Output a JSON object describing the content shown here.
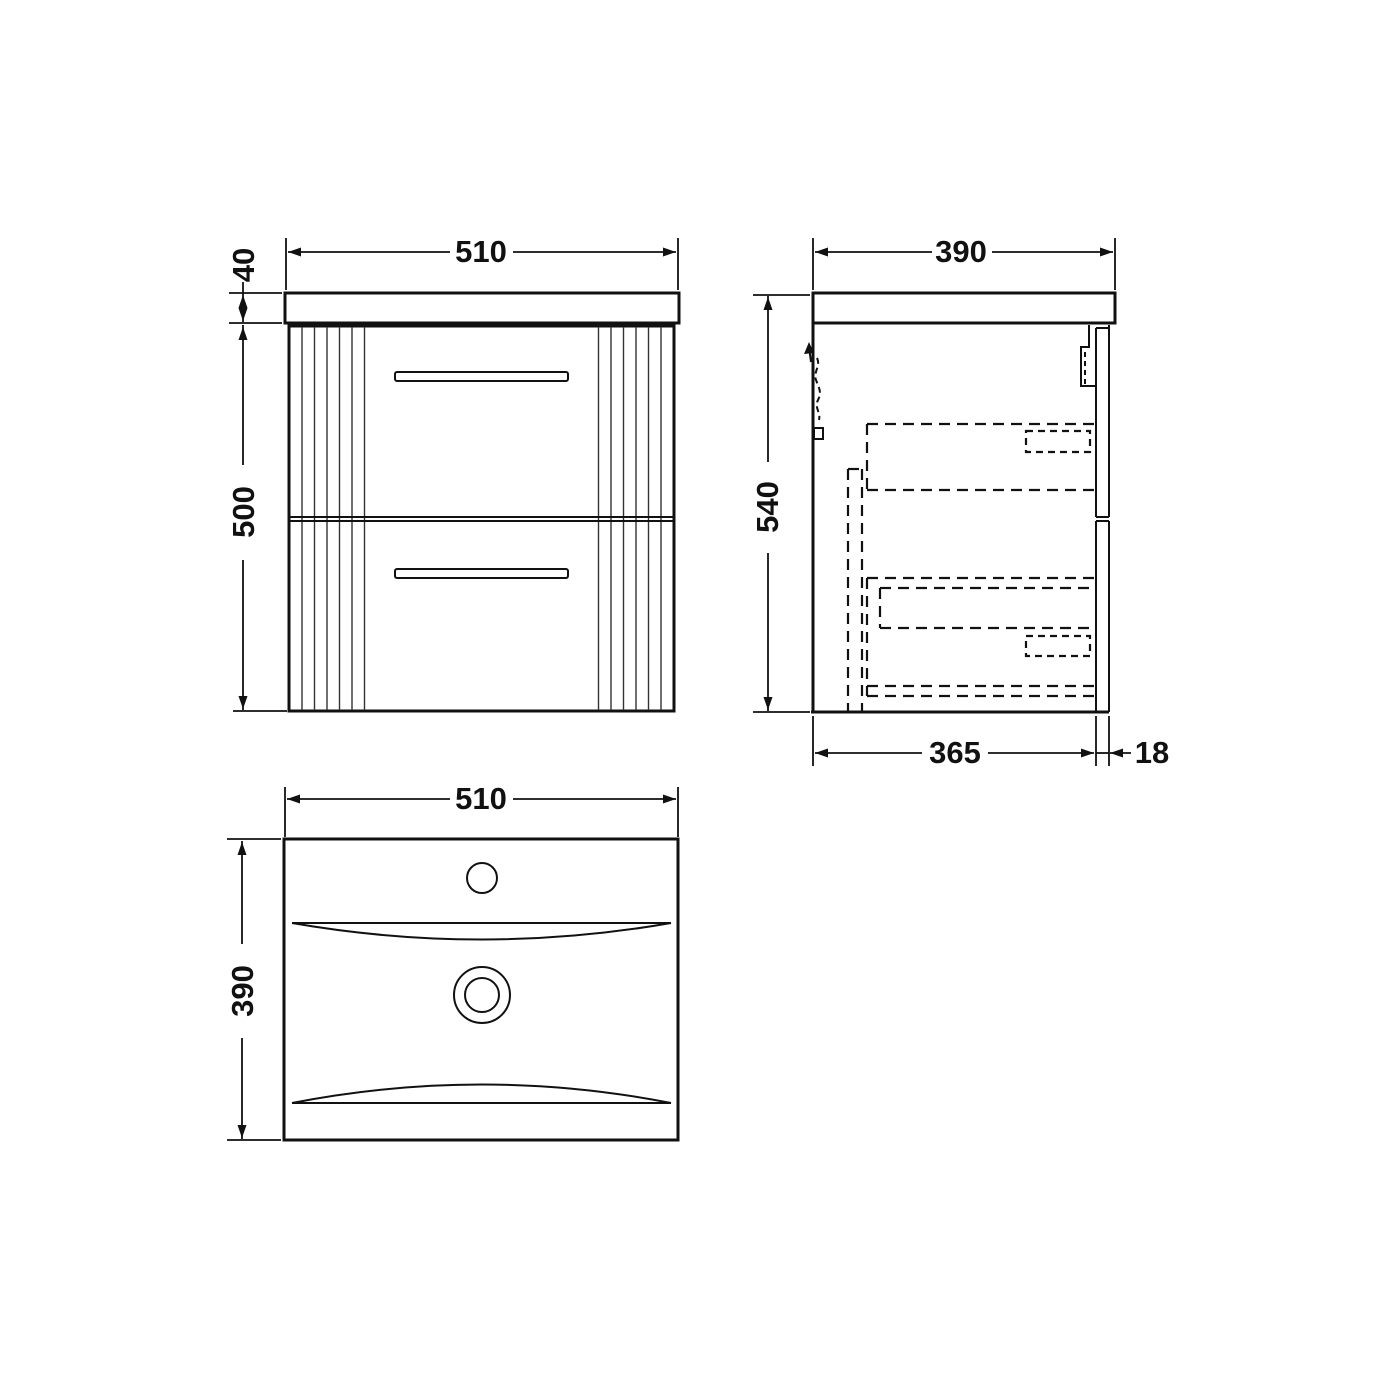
{
  "drawing": {
    "front_view": {
      "width": "510",
      "worktop_thickness": "40",
      "cabinet_height": "500"
    },
    "side_view": {
      "depth": "390",
      "overall_height": "540",
      "carcass_depth": "365",
      "drawer_front_thickness": "18"
    },
    "plan_view": {
      "width": "510",
      "depth": "390"
    },
    "colors": {
      "line": "#111111",
      "background": "#ffffff"
    }
  }
}
